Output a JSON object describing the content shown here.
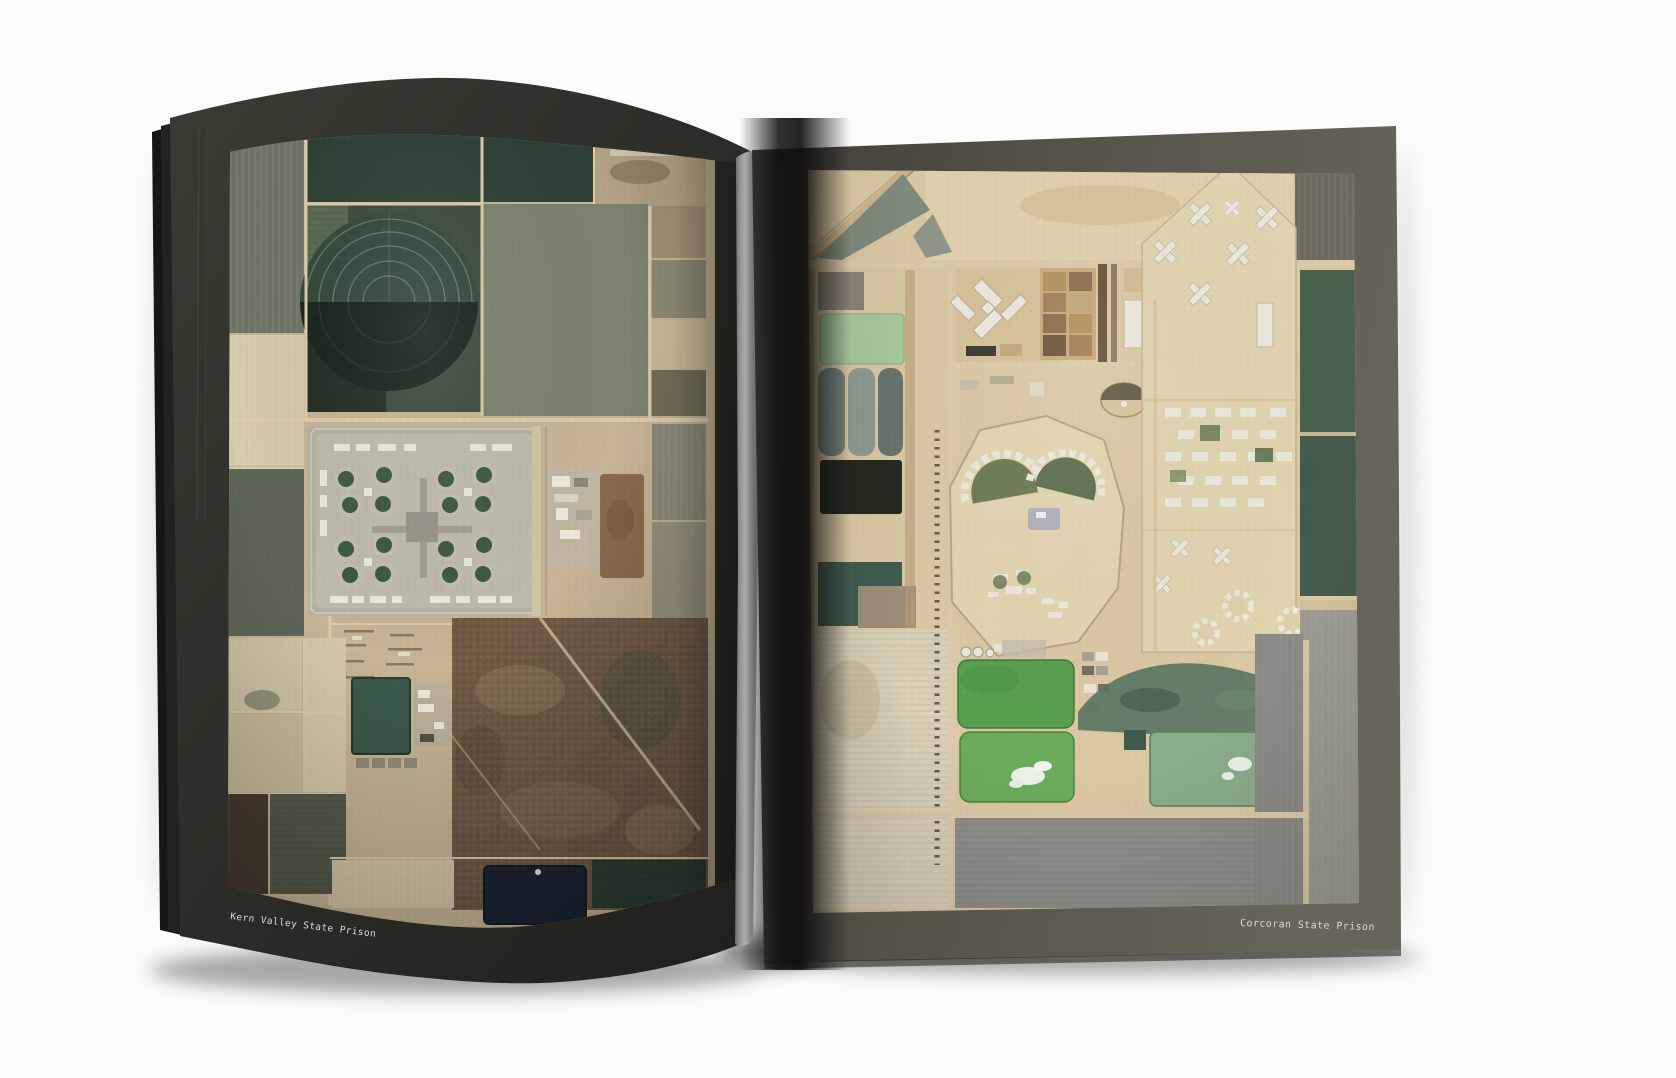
{
  "book": {
    "left_page": {
      "caption": "Kern Valley State Prison"
    },
    "right_page": {
      "caption": "Corcoran State Prison"
    }
  },
  "palette": {
    "bg": "#fbfbfa",
    "page_left_dark_a": "#3a3b33",
    "page_left_dark_b": "#20211c",
    "page_right_a": "#3f3d35",
    "page_right_b": "#5c5950",
    "page_right_c": "#67645a",
    "page_under": "#161612",
    "page_under2": "#23231d",
    "gutter": "#0d0c0a",
    "curl_light": "#c7c7c3",
    "caption_text": "#dcdad2",
    "l_base": "#c6b494",
    "road": "#dccbaa",
    "field_graygreen": "#6e7465",
    "field_graygreen2": "#5e6659",
    "field_graygreen3": "#7b8270",
    "field_pale": "#d6caac",
    "field_dark_green": "#2e4034",
    "circle_green": "#33493a",
    "circle_dark": "#19241c",
    "circle_ring": "#93a392",
    "rough_tan": "#b2a182",
    "prison_base": "#b5b1a2",
    "prison_light": "#c3bfaf",
    "yard_green": "#3e5a41",
    "building_white": "#ebe8dc",
    "brown_patch": "#8a6a4c",
    "scrub": "#6e5a45",
    "pond_teal": "#3a594a",
    "pond_navy": "#1c2432",
    "dark_rows_green": "#2d3f34",
    "r_base": "#dbc9a4",
    "sand_light": "#e1d0ab",
    "sand_compound": "#e3d5b1",
    "field_green_light": "#a7ca9d",
    "teal_round1": "#76867f",
    "teal_round2": "#8d9a91",
    "teal_round3": "#66736d",
    "field_black": "#25281f",
    "field_darkteal": "#405c4f",
    "pale_rows": "#d9d0b7",
    "pond_bright1": "#58a04e",
    "pond_bright2": "#6cab5b",
    "pond_muted": "#8bad89",
    "pond_cloud": "#edf2e9",
    "wetland": "#5c7663",
    "fan_green1": "#6d7c53",
    "fan_green2": "#5f7150",
    "lavender": "#b1aebd",
    "grid_brown1": "#b3945f",
    "grid_brown2": "#8f7050",
    "green_field_right": "#4a614f",
    "gray_field": "#90908a",
    "gray_field2": "#8a8a84",
    "dark_strip_right": "#6e6a60"
  }
}
